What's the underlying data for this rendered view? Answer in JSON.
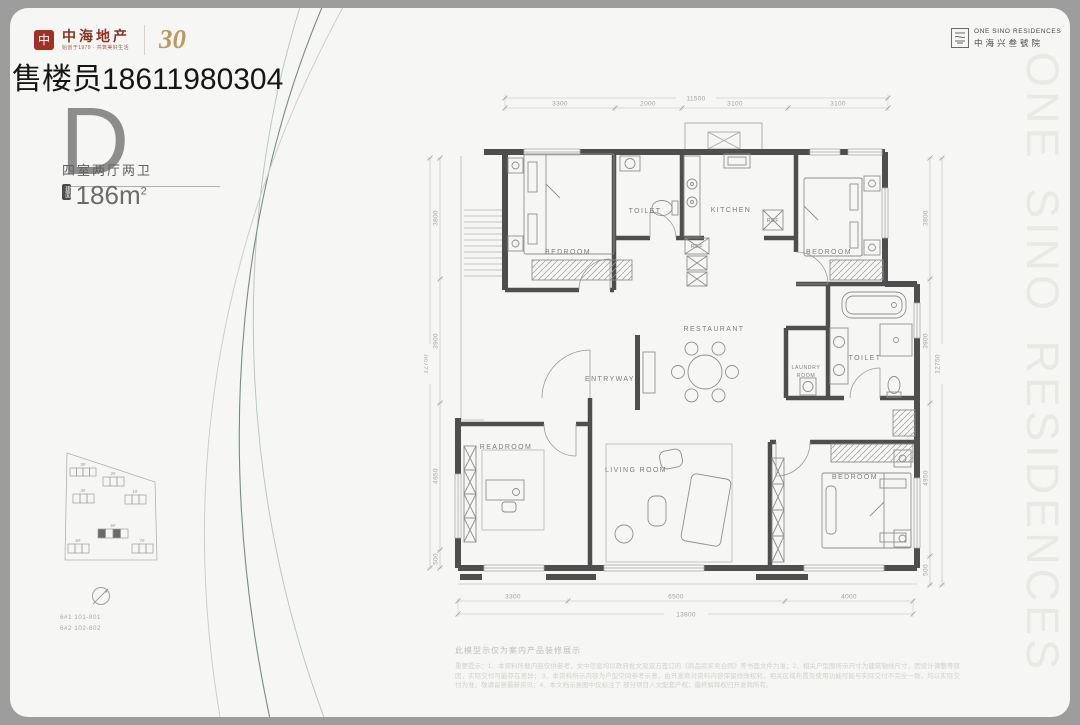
{
  "frame": {
    "outer_bg": "#9d9d9d",
    "card_bg": "#f6f6f4",
    "accent_red": "#a03024",
    "accent_gold": "#bd9a5f",
    "wall_color": "#4e4e4e"
  },
  "watermark": "售楼员18611980304",
  "brand_left": {
    "seal_glyph": "中",
    "name": "中海地产",
    "tagline": "始创于1979 · 共筑美好生活",
    "anniversary": "30"
  },
  "brand_right": {
    "en": "ONE SINO RESIDENCES",
    "cn": "中海兴叁號院"
  },
  "side_text": "ONE SINO RESIDENCES",
  "unit": {
    "type": "D",
    "layout": "四室两厅两卫",
    "area_badge": "建面",
    "area": "186m",
    "area_sup": "2"
  },
  "siteplan": {
    "b1": "3#",
    "b2": "2#",
    "b3": "4#",
    "b4": "1#",
    "b5": "6#",
    "b6": "5#",
    "b7": "7#",
    "note1": "6#1 101-801",
    "note2": "6#2 102-802"
  },
  "plan": {
    "rooms": {
      "bedroom1": "BEDROOM",
      "toilet1": "TOILET",
      "kitchen": "KITCHEN",
      "ref1": "REF",
      "ref2": "REF",
      "bedroom2": "BEDROOM",
      "laundry_l1": "LAUNDRY",
      "laundry_l2": "ROOM",
      "toilet2": "TOILET",
      "restaurant": "RESTAURANT",
      "entryway": "ENTRYWAY",
      "readroom": "READROOM",
      "living": "LIVING ROOM",
      "bedroom3": "BEDROOM"
    },
    "dims": {
      "top_total": "11500",
      "top1": "3300",
      "top2": "2000",
      "top3": "3100",
      "top4": "3100",
      "bottom_total": "13800",
      "bottom1": "3300",
      "bottom2": "6500",
      "bottom3": "4000",
      "left_total": "12750",
      "left1": "3800",
      "left2": "3900",
      "left3": "4650",
      "left4": "500",
      "right_total": "12750",
      "right1": "3800",
      "right2": "3900",
      "right3": "4950",
      "right4": "500"
    }
  },
  "disclaimer": {
    "title": "此模型示仅为案内产品装修展示",
    "line1": "重要提示：1、本资料所载内容仅供参考，文中信息均以政府批文及双方签订的《商品房买卖合同》等书面文件为准；2、相关户型图所示尺寸为建筑轴线尺寸，因设计调整等原因，实际交付可能存在差异；",
    "line2": "3、本资料所示内容为户型空间参考示意，由开发商对资料内容保留修改权利，相关区域布置及使用功能可能与实际交付不完全一致，均以实际交付为准，敬请留意最新资讯；4、本文档示意图中仅标注了",
    "line3": "部分项目人文配套产权；最终解释权归开发商所有。"
  }
}
